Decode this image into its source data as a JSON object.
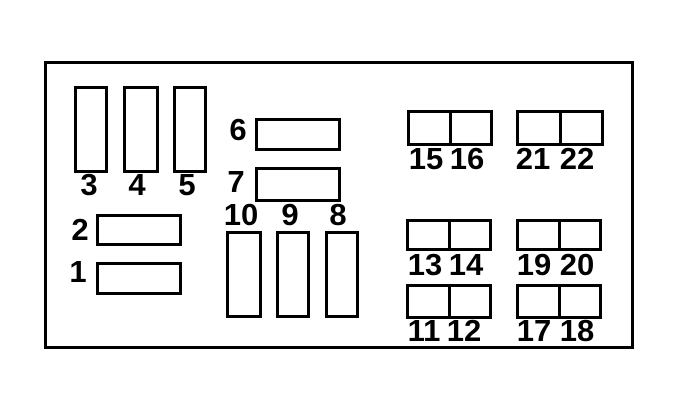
{
  "colors": {
    "line": "#000000",
    "background": "#ffffff"
  },
  "diagram": {
    "kind": "fuse-box-diagram",
    "slot_count": 22
  },
  "fuse_labels": {
    "f1": "1",
    "f2": "2",
    "f3": "3",
    "f4": "4",
    "f5": "5",
    "f6": "6",
    "f7": "7",
    "f8": "8",
    "f9": "9",
    "f10": "10",
    "f11": "11",
    "f12": "12",
    "f13": "13",
    "f14": "14",
    "f15": "15",
    "f16": "16",
    "f17": "17",
    "f18": "18",
    "f19": "19",
    "f20": "20",
    "f21": "21",
    "f22": "22"
  }
}
